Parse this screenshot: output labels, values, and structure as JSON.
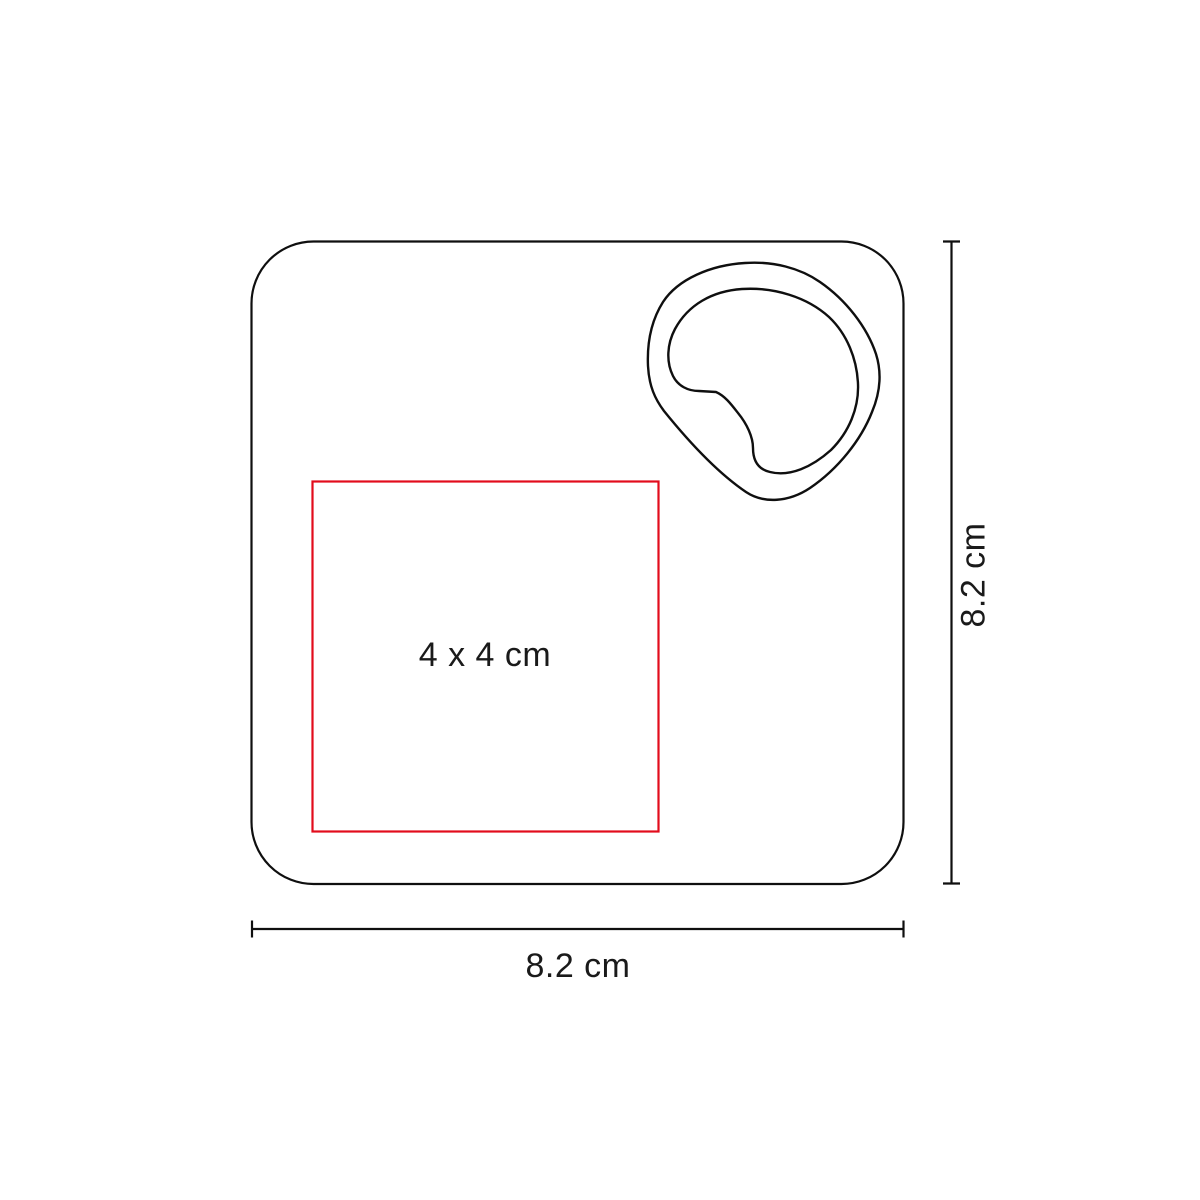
{
  "diagram": {
    "labels": {
      "print_area": "4 x 4 cm",
      "height": "8.2 cm",
      "width": "8.2 cm"
    },
    "colors": {
      "background": "#ffffff",
      "outline": "#0f0f0f",
      "print_area": "#e20c1c",
      "label_text": "#1a1a1a"
    }
  }
}
